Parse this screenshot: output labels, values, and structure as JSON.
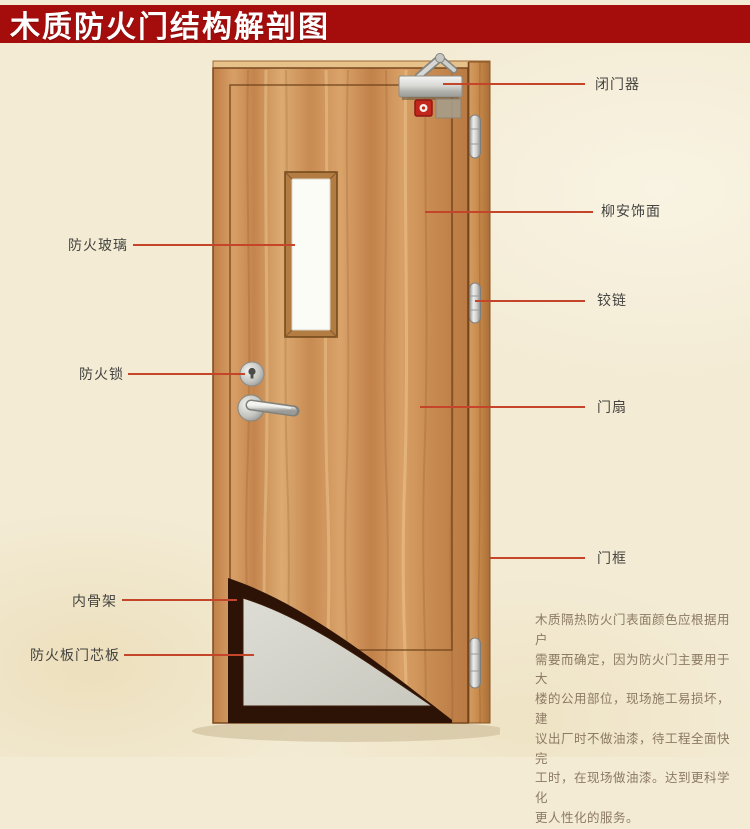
{
  "title": "木质防火门结构解剖图",
  "callouts": {
    "right": [
      {
        "id": "door-closer",
        "label": "闭门器"
      },
      {
        "id": "lauan-veneer",
        "label": "柳安饰面"
      },
      {
        "id": "hinge",
        "label": "铰链"
      },
      {
        "id": "door-leaf",
        "label": "门扇"
      },
      {
        "id": "door-frame",
        "label": "门框"
      }
    ],
    "left": [
      {
        "id": "fire-glass",
        "label": "防火玻璃"
      },
      {
        "id": "fire-lock",
        "label": "防火锁"
      },
      {
        "id": "inner-skeleton",
        "label": "内骨架"
      },
      {
        "id": "fire-board-core",
        "label": "防火板门芯板"
      }
    ]
  },
  "description": "木质隔热防火门表面颜色应根据用户\n需要而确定，因为防火门主要用于大\n楼的公用部位，现场施工易损坏，建\n议出厂时不做油漆，待工程全面快完\n工时，在现场做油漆。达到更科学化\n更人性化的服务。",
  "colors": {
    "banner": "#a40d0c",
    "pointer": "#c5452a",
    "label_text": "#454440",
    "description_text": "#8c7a64",
    "wood": "#cd9257",
    "core_board": "#d7d6cd",
    "skeleton_dark": "#2d1206"
  }
}
